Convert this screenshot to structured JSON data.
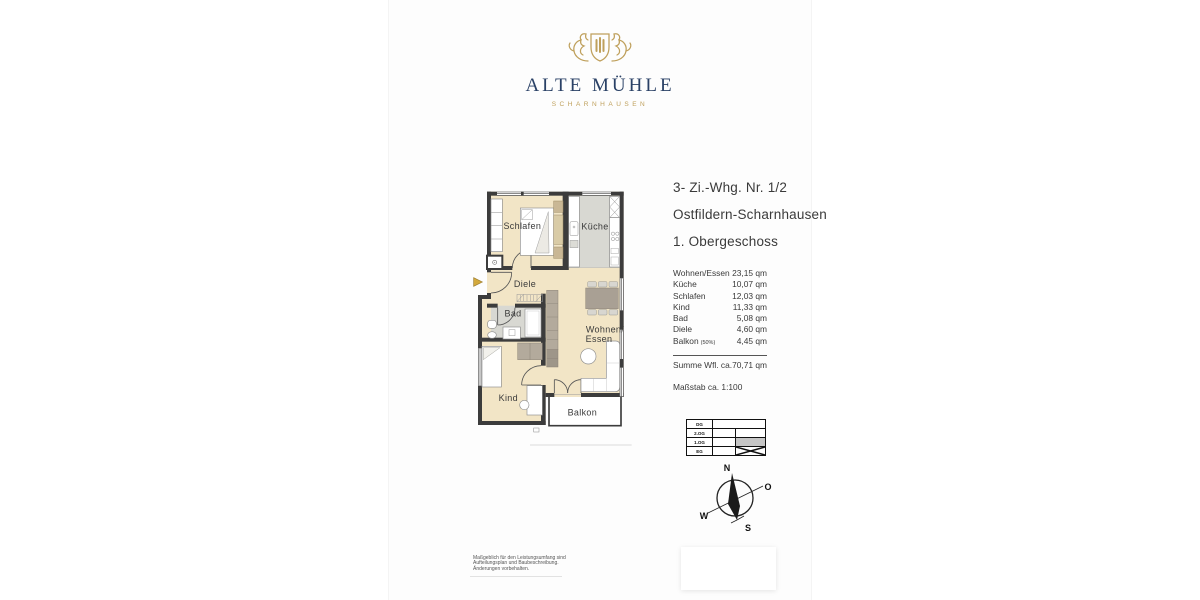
{
  "brand": {
    "name": "ALTE MÜHLE",
    "subtitle": "SCHARNHAUSEN",
    "colors": {
      "navy": "#2a4166",
      "gold": "#bfa05c"
    }
  },
  "listing": {
    "line1": "3- Zi.-Whg. Nr. 1/2",
    "line2": "Ostfildern-Scharnhausen",
    "line3": "1. Obergeschoss"
  },
  "areas": {
    "rows": [
      {
        "label": "Wohnen/Essen",
        "value": "23,15 qm"
      },
      {
        "label": "Küche",
        "value": "10,07 qm"
      },
      {
        "label": "Schlafen",
        "value": "12,03 qm"
      },
      {
        "label": "Kind",
        "value": "11,33 qm"
      },
      {
        "label": "Bad",
        "value": "5,08 qm"
      },
      {
        "label": "Diele",
        "value": "4,60 qm"
      },
      {
        "label": "Balkon",
        "note": "(50%)",
        "value": "4,45 qm"
      }
    ],
    "sum_label": "Summe Wfl. ca.",
    "sum_value": "70,71 qm",
    "scale": "Maßstab ca. 1:100"
  },
  "floor_diagram": {
    "levels": [
      "DG",
      "2.OG",
      "1.OG",
      "EG"
    ],
    "highlighted_level": "1.OG"
  },
  "compass": {
    "north": "N",
    "east": "O",
    "south": "S",
    "west": "W"
  },
  "floorplan": {
    "rooms": {
      "schlafen": "Schlafen",
      "kueche": "Küche",
      "diele": "Diele",
      "bad": "Bad",
      "kind": "Kind",
      "wohnen_line1": "Wohnen/",
      "wohnen_line2": "Essen",
      "balkon": "Balkon"
    },
    "colors": {
      "floor_beige": "#f2e5c6",
      "floor_gray": "#d8d8d2",
      "wall": "#3c3c3c",
      "entrance_arrow": "#d3a93c"
    }
  },
  "disclaimer": {
    "line1": "Maßgeblich für den Leistungsumfang sind",
    "line2": "Aufteilungsplan und Baubeschreibung.",
    "line3": "Änderungen vorbehalten."
  }
}
